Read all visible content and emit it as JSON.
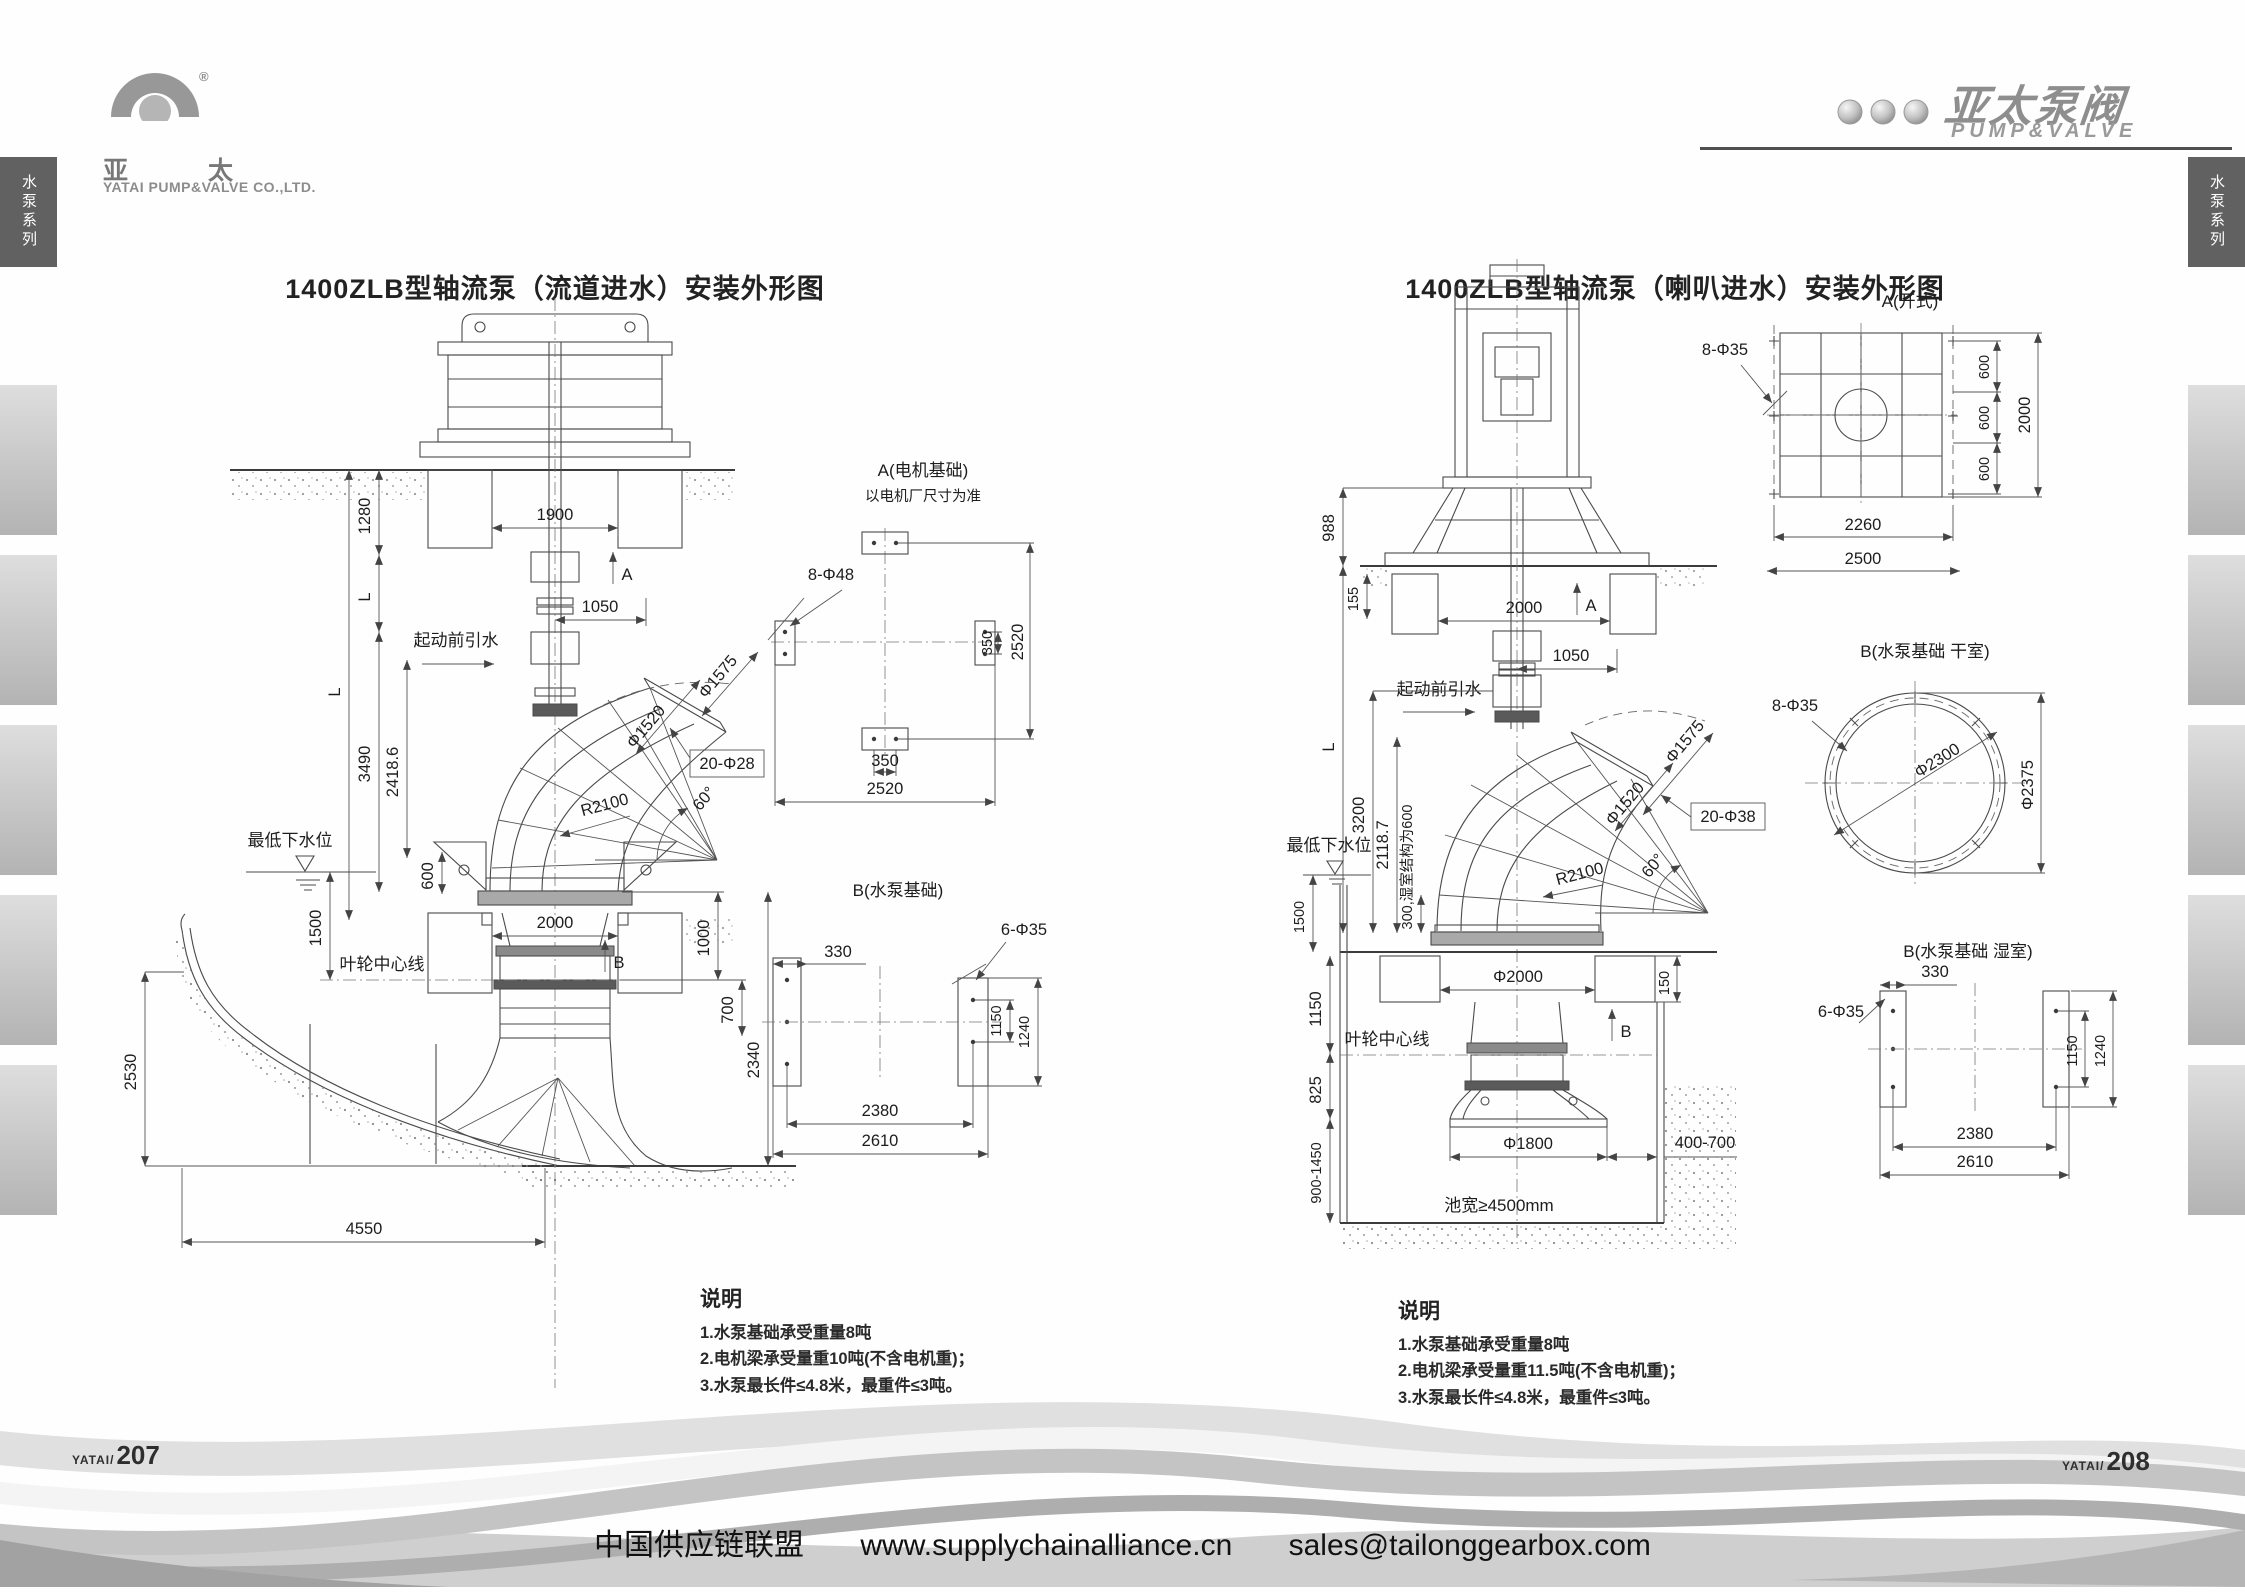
{
  "header": {
    "logo_left": {
      "cn_left": "亚",
      "cn_right": "太",
      "reg": "®",
      "company": "YATAI PUMP&VALVE CO.,LTD."
    },
    "logo_right": {
      "cn": "亚太泵阀",
      "en": "PUMP&VALVE"
    }
  },
  "rails": {
    "left_label": "水泵系列",
    "right_label": "水泵系列"
  },
  "fig1": {
    "title": "1400ZLB型轴流泵（流道进水）安装外形图",
    "dims": {
      "d1900": "1900",
      "d1280": "1280",
      "dL": "L",
      "d3490": "3490",
      "d2418": "2418.6",
      "d600": "600",
      "d1050": "1050",
      "dA": "A",
      "prime": "起动前引水",
      "phi1575": "Φ1575",
      "phi1520": "Φ1520",
      "d20_28": "20-Φ28",
      "d60": "60°",
      "r2100": "R2100",
      "level": "最低下水位",
      "d1500": "1500",
      "impeller": "叶轮中心线",
      "d2000": "2000",
      "dB": "B",
      "d1000": "1000",
      "d700": "700",
      "d2340": "2340",
      "d2530": "2530",
      "d4550": "4550"
    },
    "subA": {
      "title": "A(电机基础)",
      "subtitle": "以电机厂尺寸为准",
      "bolt": "8-Φ48",
      "d350": "350",
      "d2520": "2520"
    },
    "subB": {
      "title": "B(水泵基础)",
      "d330": "330",
      "bolt": "6-Φ35",
      "d1150": "1150",
      "d1240": "1240",
      "d2380": "2380",
      "d2610": "2610"
    },
    "notes": {
      "title": "说明",
      "n1": "1.水泵基础承受重量8吨",
      "n2": "2.电机梁承受量重10吨(不含电机重)；",
      "n3": "3.水泵最长件≤4.8米，最重件≤3吨。"
    }
  },
  "fig2": {
    "title": "1400ZLB型轴流泵（喇叭进水）安装外形图",
    "dims": {
      "d988": "988",
      "d155": "155",
      "d2000": "2000",
      "dA": "A",
      "d1050": "1050",
      "prime": "起动前引水",
      "dL": "L",
      "d3200": "3200",
      "d2118": "2118.7",
      "d300": "300,湿室结构为600",
      "phi1575": "Φ1575",
      "phi1520": "Φ1520",
      "d20_38": "20-Φ38",
      "d60": "60°",
      "r2100": "R2100",
      "level": "最低下水位",
      "d1500": "1500",
      "d1150": "1150",
      "impeller": "叶轮中心线",
      "phi2000": "Φ2000",
      "dB": "B",
      "d150": "150",
      "d825": "825",
      "d900": "900-1450",
      "phi1800": "Φ1800",
      "d400": "400-700",
      "pool": "池宽≥4500mm"
    },
    "subA": {
      "title": "A(开式)",
      "bolt": "8-Φ35",
      "d600": "600",
      "d2000": "2000",
      "d2260": "2260",
      "d2500": "2500"
    },
    "subB1": {
      "title": "B(水泵基础 干室)",
      "bolt": "8-Φ35",
      "phi2300": "Φ2300",
      "phi2375": "Φ2375"
    },
    "subB2": {
      "title": "B(水泵基础 湿室)",
      "d330": "330",
      "bolt": "6-Φ35",
      "d1150": "1150",
      "d1240": "1240",
      "d2380": "2380",
      "d2610": "2610"
    },
    "notes": {
      "title": "说明",
      "n1": "1.水泵基础承受重量8吨",
      "n2": "2.电机梁承受量重11.5吨(不含电机重)；",
      "n3": "3.水泵最长件≤4.8米，最重件≤3吨。"
    }
  },
  "footer": {
    "page_left_brand": "YATAI/",
    "page_left_num": "207",
    "page_right_brand": "YATAI/",
    "page_right_num": "208",
    "org": "中国供应链联盟",
    "url": "www.supplychainalliance.cn",
    "email": "sales@tailonggearbox.com"
  }
}
